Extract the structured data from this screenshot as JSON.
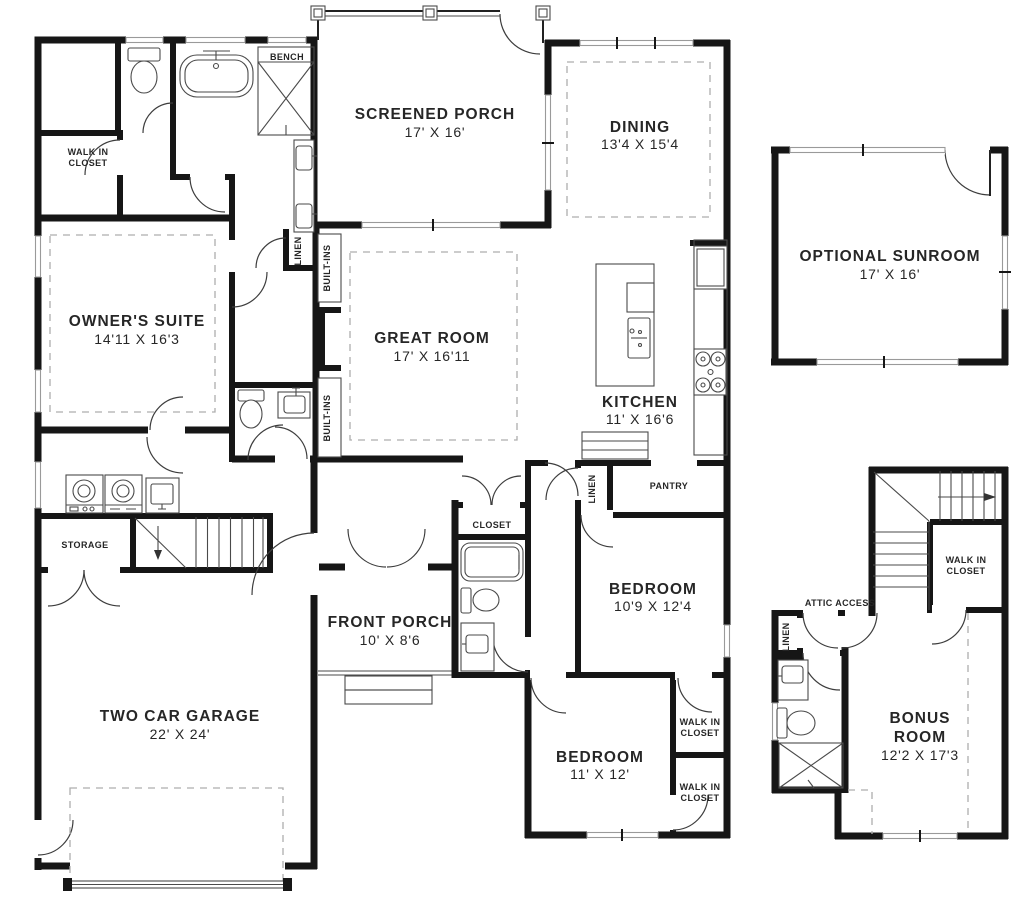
{
  "plan": {
    "rooms": {
      "screened_porch": {
        "name": "SCREENED PORCH",
        "dims": "17' X 16'"
      },
      "dining": {
        "name": "DINING",
        "dims": "13'4 X 15'4"
      },
      "sunroom": {
        "name": "OPTIONAL SUNROOM",
        "dims": "17' X 16'"
      },
      "owners_suite": {
        "name": "OWNER'S SUITE",
        "dims": "14'11 X 16'3"
      },
      "great_room": {
        "name": "GREAT ROOM",
        "dims": "17' X 16'11"
      },
      "kitchen": {
        "name": "KITCHEN",
        "dims": "11' X 16'6"
      },
      "front_porch": {
        "name": "FRONT PORCH",
        "dims": "10' X 8'6"
      },
      "garage": {
        "name": "TWO CAR GARAGE",
        "dims": "22' X 24'"
      },
      "bedroom1": {
        "name": "BEDROOM",
        "dims": "10'9 X 12'4"
      },
      "bedroom2": {
        "name": "BEDROOM",
        "dims": "11' X 12'"
      },
      "bonus": {
        "name_line1": "BONUS",
        "name_line2": "ROOM",
        "dims": "12'2 X 17'3"
      }
    },
    "labels": {
      "bench": "BENCH",
      "walk_in_line1": "WALK IN",
      "walk_in_line2": "CLOSET",
      "linen": "LINEN",
      "built_ins": "BUILT-INS",
      "pantry": "PANTRY",
      "storage": "STORAGE",
      "closet": "CLOSET",
      "attic_access": "ATTIC ACCESS"
    }
  }
}
